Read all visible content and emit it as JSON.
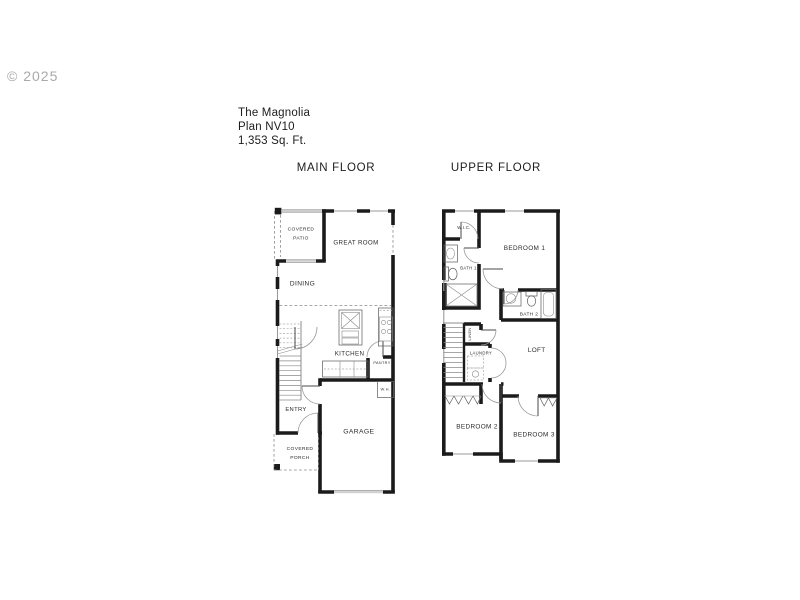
{
  "watermark": "© 2025",
  "plan": {
    "name": "The Magnolia",
    "number": "Plan NV10",
    "area": "1,353 Sq. Ft."
  },
  "floors": {
    "main": {
      "heading": "MAIN FLOOR",
      "rooms": {
        "covered_patio": [
          "COVERED",
          "PATIO"
        ],
        "great_room": "GREAT ROOM",
        "dining": "DINING",
        "kitchen": "KITCHEN",
        "pantry": "PANTRY",
        "water_heater": "W.H.",
        "entry": "ENTRY",
        "garage": "GARAGE",
        "covered_porch": [
          "COVERED",
          "PORCH"
        ]
      }
    },
    "upper": {
      "heading": "UPPER FLOOR",
      "rooms": {
        "walk_in_closet": "W.I.C.",
        "bedroom_1": "BEDROOM 1",
        "bath_1": "BATH 1",
        "bath_2": "BATH 2",
        "linen": "LINEN",
        "laundry": "LAUNDRY",
        "loft": "LOFT",
        "bedroom_2": "BEDROOM 2",
        "bedroom_3": "BEDROOM 3"
      }
    }
  },
  "colors": {
    "background": "#ffffff",
    "wall": "#1b1b1b",
    "window_line": "#9a9a9a",
    "dashed_line": "#8a8a8a",
    "fixture_line": "#666666",
    "label_text": "#2b2b2b",
    "watermark_text": "#a9a9a9"
  }
}
